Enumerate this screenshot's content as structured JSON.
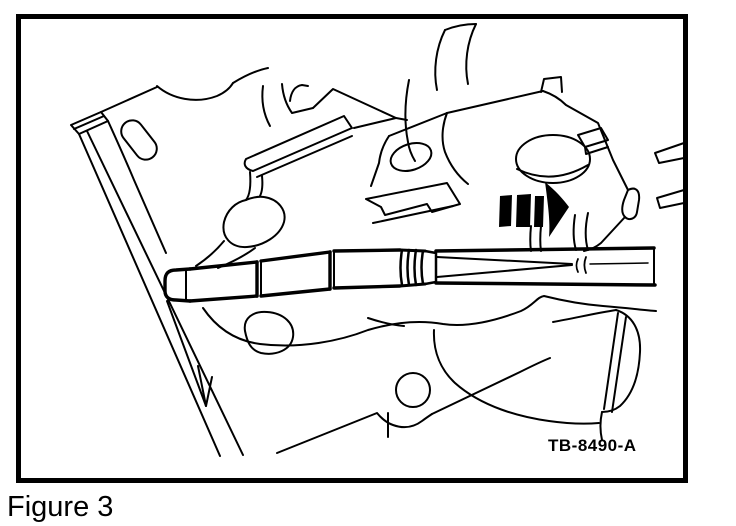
{
  "figure": {
    "caption": "Figure 3",
    "tool_label": "TB-8490-A"
  },
  "illustration": {
    "subject": "engine cylinder head cross-section with glow plug installer tool",
    "arrow_icon": "insertion-direction-arrow-right"
  },
  "colors": {
    "line": "#000000",
    "background": "#ffffff"
  }
}
